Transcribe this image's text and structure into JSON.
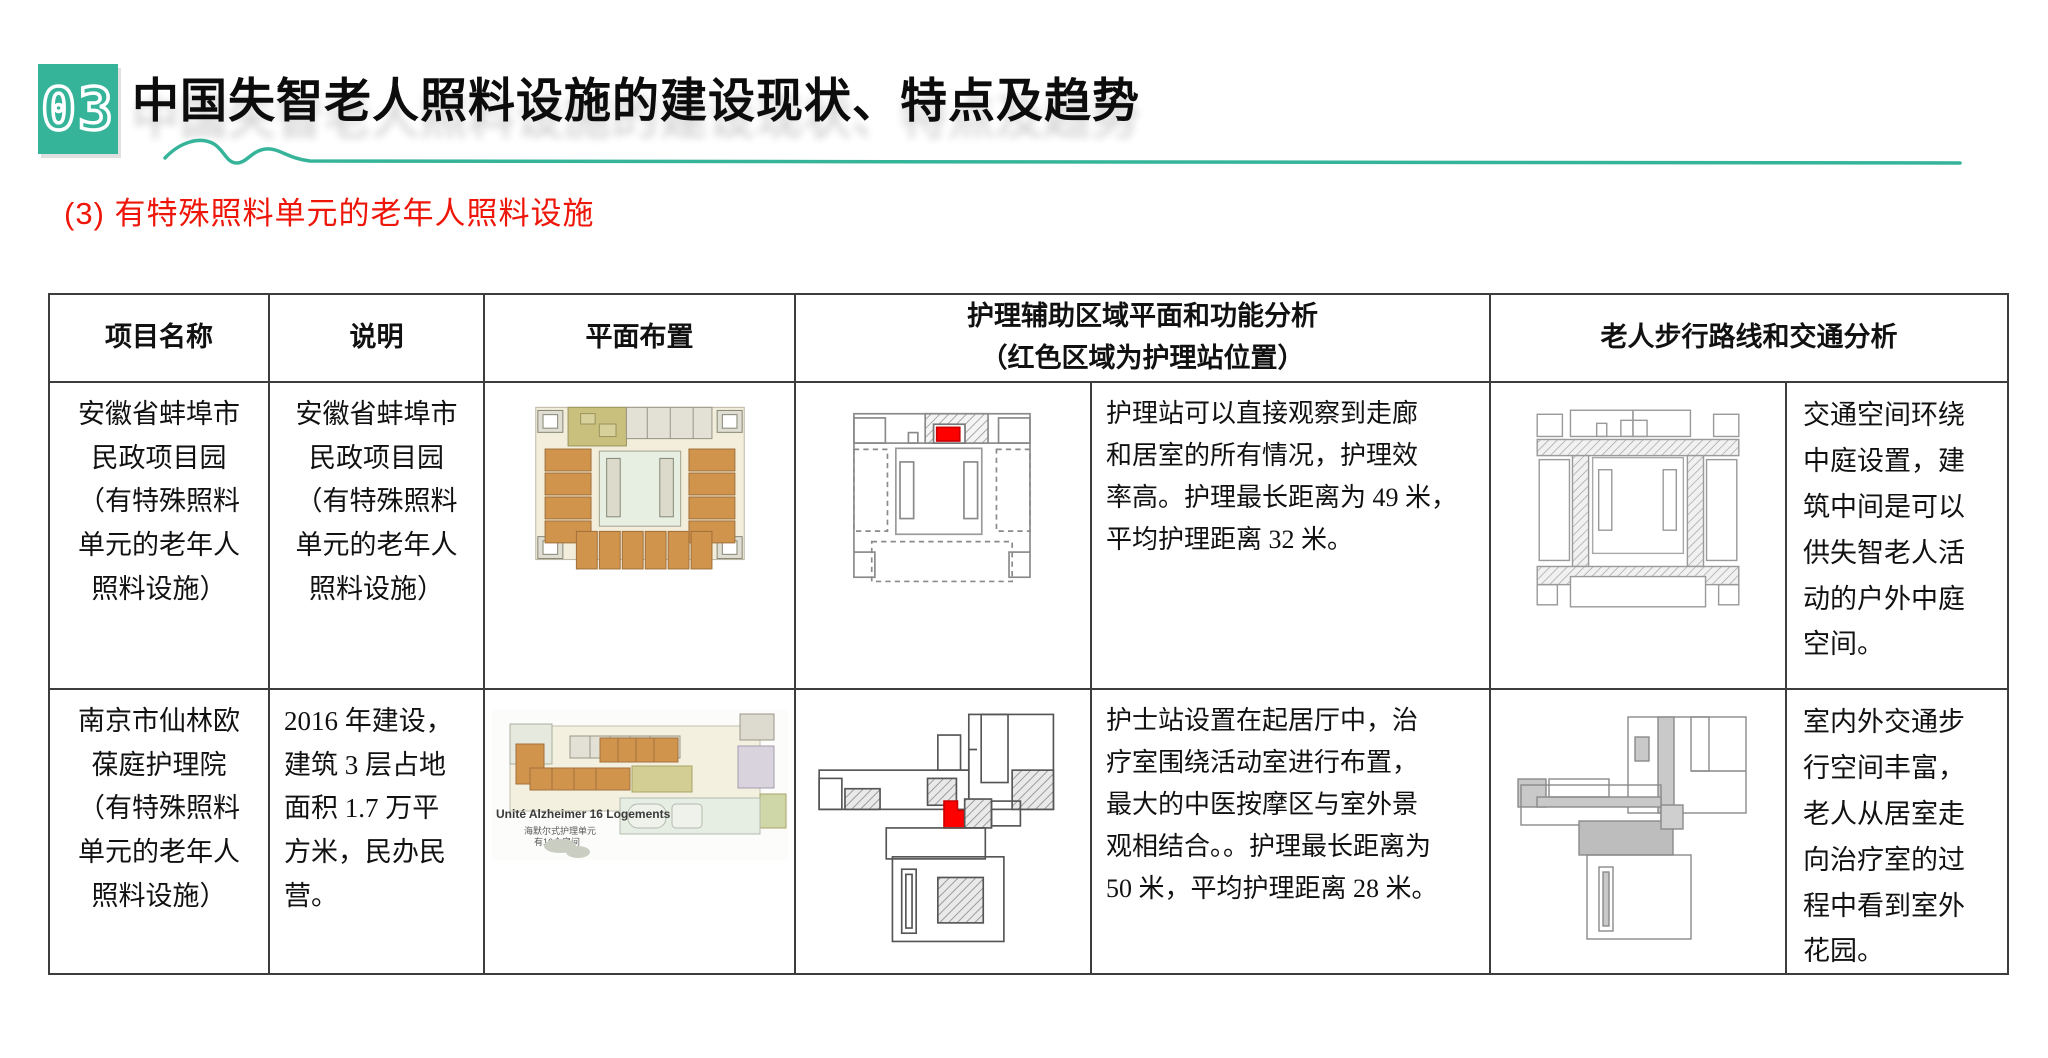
{
  "header": {
    "section_number": "03",
    "title": "中国失智老人照料设施的建设现状、特点及趋势",
    "subtitle": "(3) 有特殊照料单元的老年人照料设施"
  },
  "colors": {
    "accent_teal": "#35b49a",
    "subtitle_red": "#ee1509",
    "nursing_station_red": "#fe0000",
    "table_border": "#3d3d3d"
  },
  "table": {
    "column_headers": {
      "project_name": "项目名称",
      "description": "说明",
      "floor_plan": "平面布置",
      "nursing_analysis": "护理辅助区域平面和功能分析\n（红色区域为护理站位置）",
      "walking_analysis": "老人步行路线和交通分析"
    },
    "rows": [
      {
        "project_name": "安徽省蚌埠市\n民政项目园\n（有特殊照料\n单元的老年人\n照料设施）",
        "description": "安徽省蚌埠市\n民政项目园\n（有特殊照料\n单元的老年人\n照料设施）",
        "nursing_analysis_text": "护理站可以直接观察到走廊\n和居室的所有情况，护理效\n率高。护理最长距离为 49 米，\n平均护理距离 32 米。",
        "walking_analysis_text": "交通空间环绕\n中庭设置，建\n筑中间是可以\n供失智老人活\n动的户外中庭\n空间。"
      },
      {
        "project_name": "南京市仙林欧\n葆庭护理院\n（有特殊照料\n单元的老年人\n照料设施）",
        "description": "2016 年建设，\n建筑 3 层占地\n面积 1.7 万平\n方米，民办民\n营。",
        "floor_plan_label": "Unité Alzheimer 16 Logements",
        "floor_plan_caption_line1": "海默尔式护理单元",
        "floor_plan_caption_line2": "有16个房间",
        "nursing_analysis_text": "护士站设置在起居厅中，治\n疗室围绕活动室进行布置，\n最大的中医按摩区与室外景\n观相结合。。护理最长距离为\n50 米，平均护理距离 28 米。",
        "walking_analysis_text": "室内外交通步\n行空间丰富，\n老人从居室走\n向治疗室的过\n程中看到室外\n花园。"
      }
    ]
  }
}
